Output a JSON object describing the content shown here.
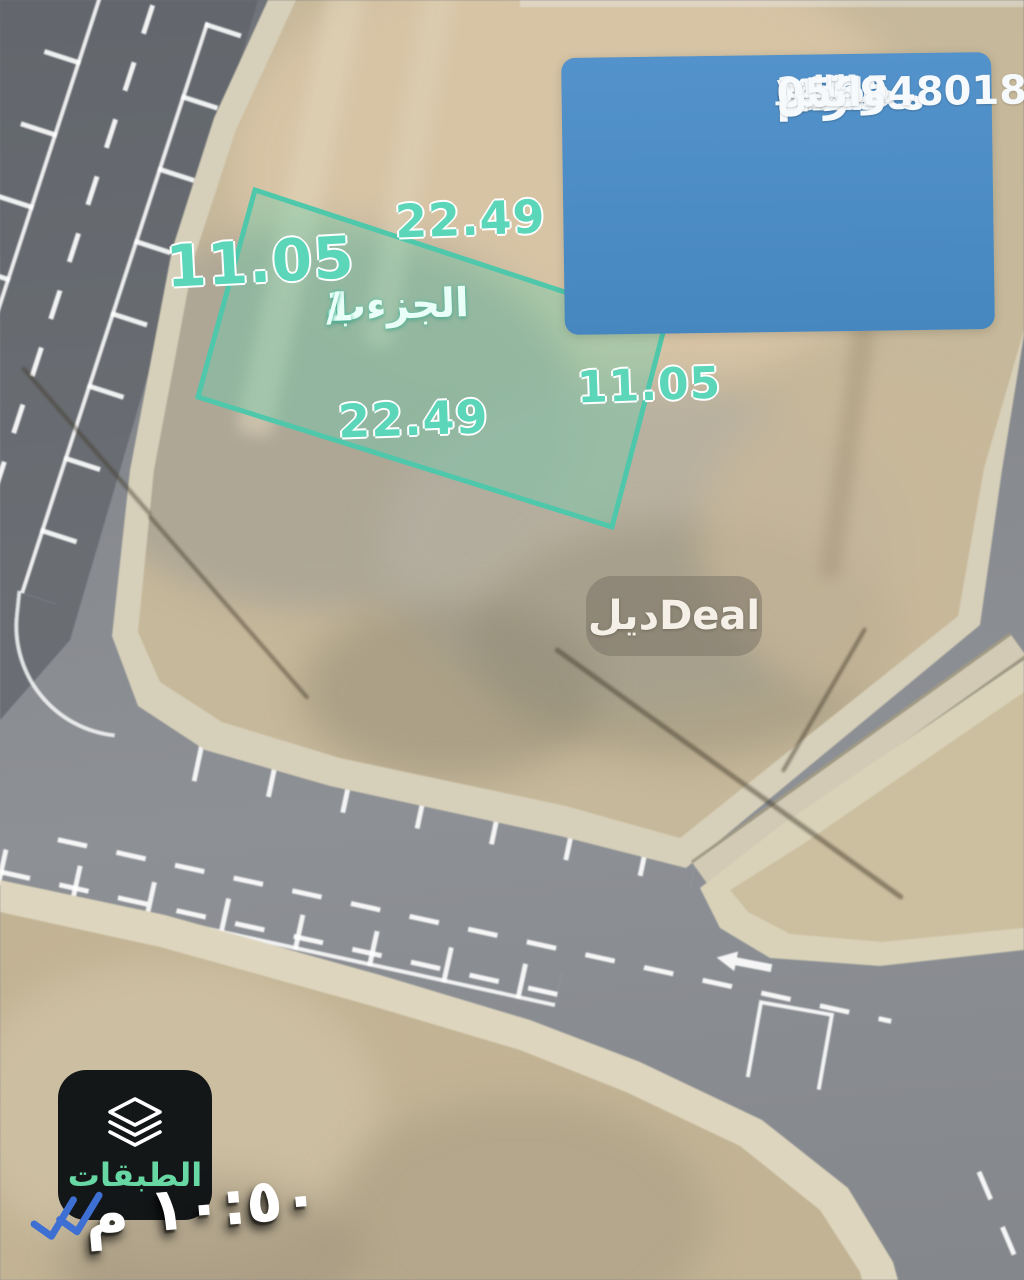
{
  "info_card": {
    "bg_color": "#4b8dc6",
    "line1": "مخطط ارام",
    "line2": "ارض للبيع مساحه 247.5 م٢",
    "line3": "٥٤٠ الف واجهه غربيه شارع ١٥ متر",
    "line4": "0569480187 واتس"
  },
  "plot": {
    "label": "الجزءب 1 /",
    "dim_top": "22.49",
    "dim_bottom": "22.49",
    "dim_left": "11.05",
    "dim_right": "11.05",
    "outline_color": "#4fc7ab",
    "dim_color": "#5bd6b8"
  },
  "watermark": {
    "arabic": "ديل",
    "latin": "Deal"
  },
  "layers_button": {
    "label": "الطبقات",
    "label_color": "#67d7a3",
    "icon": "layers-icon"
  },
  "message_meta": {
    "time": "١٠:٥٠ م",
    "icon": "double-check-icon",
    "check_color": "#3e6fd2"
  }
}
